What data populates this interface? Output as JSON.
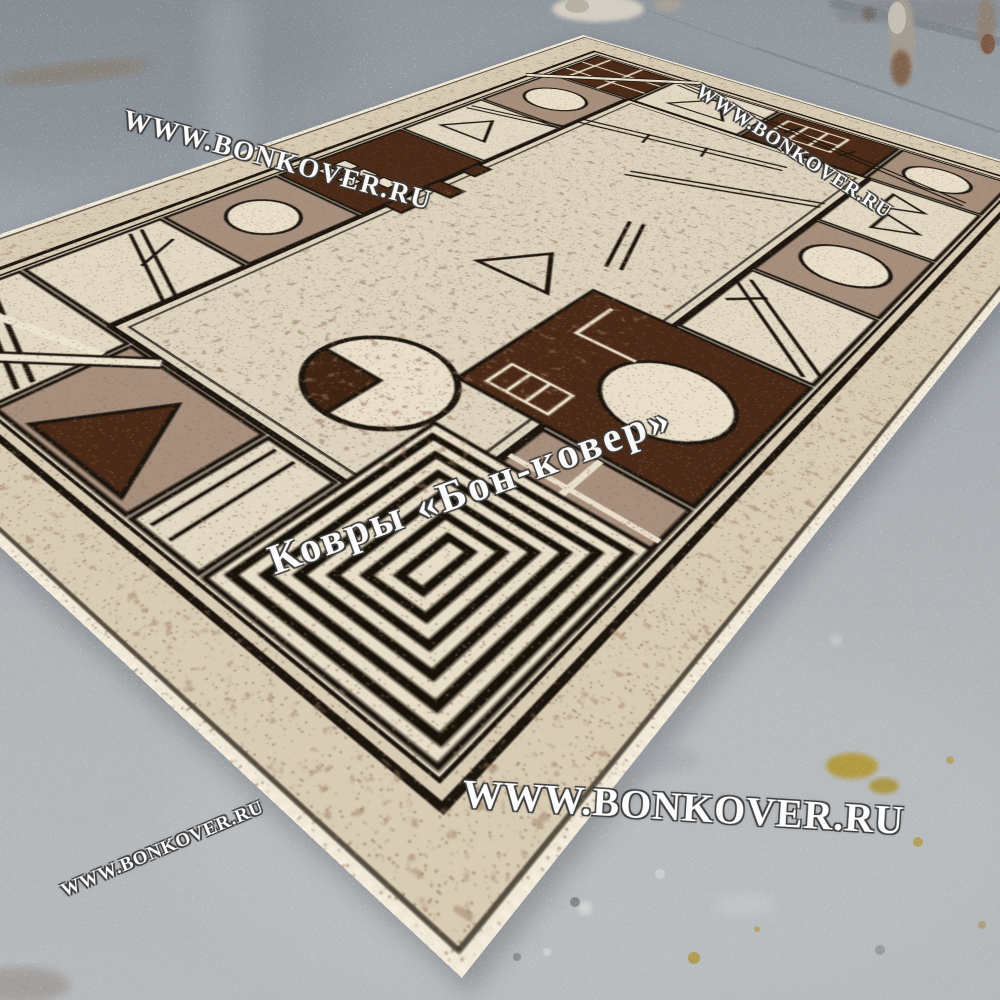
{
  "scene": {
    "type": "product photograph",
    "subject": "Beige and brown geometric Kandinsky-style carpet lying diagonally on a gray painted concrete floor",
    "background_objects": "gray metal rack with rusty legs at top edge of photo"
  },
  "watermarks": {
    "top_left": "WWW.BONKOVER.RU",
    "top_right": "WWW.BONKOVER.RU",
    "center": "Ковры «Бон-ковер»",
    "bottom": "WWW.BONKOVER.RU",
    "bottom_left": "WWW.BONKOVER.RU"
  },
  "palette": {
    "floor_gray": "#a9aeb4",
    "carpet_cream": "#e2d8c3",
    "carpet_taupe": "#a78f7d",
    "carpet_chocolate": "#4a2a17",
    "carpet_outline": "#1b150e",
    "carpet_binding": "#f0e8d7",
    "stain_yellow": "#b2952e",
    "watermark_white": "#ffffff"
  }
}
